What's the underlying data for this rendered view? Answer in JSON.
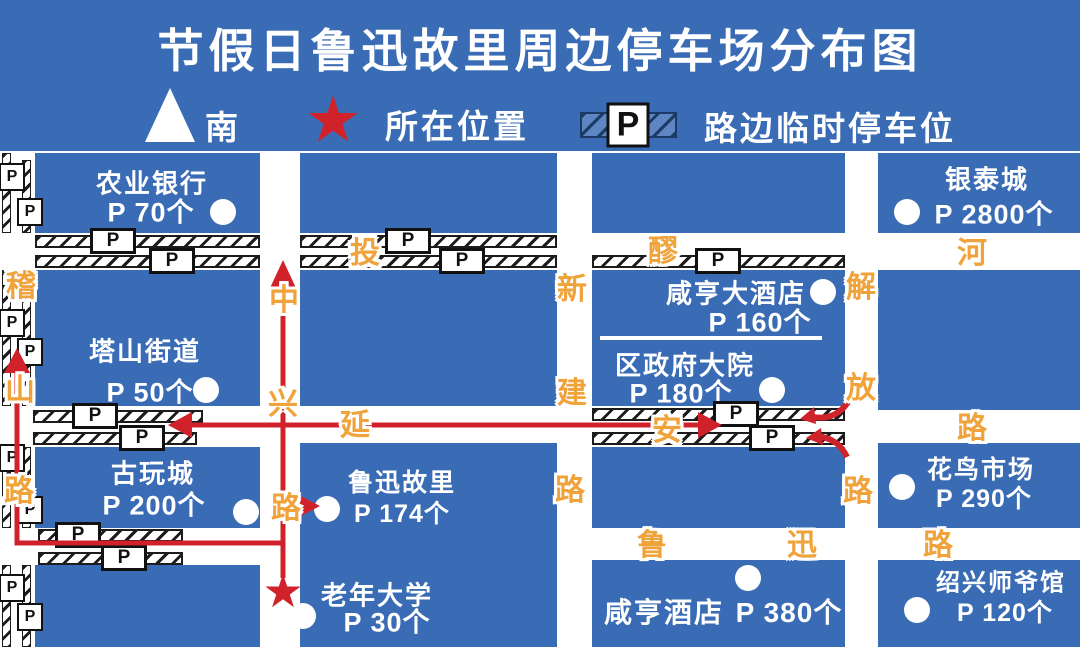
{
  "title": "节假日鲁迅故里周边停车场分布图",
  "colors": {
    "block_blue": "#3a6cb5",
    "road_white": "#ffffff",
    "street_name_orange": "#efa33a",
    "route_red": "#d0222a",
    "sign_black": "#1c1c1c"
  },
  "legend": {
    "south": "南",
    "current_location": "所在位置",
    "roadside_parking": "路边临时停车位"
  },
  "symbols": {
    "p": "P",
    "star": "★"
  },
  "venues": {
    "nongye_bank": {
      "name": "农业银行",
      "capacity": "P 70个"
    },
    "yintai_city": {
      "name": "银泰城",
      "capacity": "P 2800个"
    },
    "tashan_street": {
      "name": "塔山街道",
      "capacity": "P 50个"
    },
    "xianheng_grand_hotel": {
      "name": "咸亨大酒店",
      "capacity": "P 160个"
    },
    "district_gov": {
      "name": "区政府大院",
      "capacity": "P 180个"
    },
    "antique_city": {
      "name": "古玩城",
      "capacity": "P 200个"
    },
    "luxun_hometown": {
      "name": "鲁迅故里",
      "capacity": "P 174个"
    },
    "flower_bird_market": {
      "name": "花鸟市场",
      "capacity": "P 290个"
    },
    "senior_university": {
      "name": "老年大学",
      "capacity": "P 30个"
    },
    "xianheng_hotel": {
      "name": "咸亨酒店",
      "capacity": "P 380个"
    },
    "shaoxing_shiye_museum": {
      "name": "绍兴师爷馆",
      "capacity": "P 120个"
    }
  },
  "roads": {
    "toulao_river": {
      "name": "投醪河",
      "chars": [
        "投",
        "醪",
        "河"
      ]
    },
    "yanan_road": {
      "name": "延安路",
      "chars": [
        "延",
        "安",
        "路"
      ]
    },
    "luxun_road": {
      "name": "鲁迅路",
      "chars": [
        "鲁",
        "迅",
        "路"
      ]
    },
    "jishan_road": {
      "name": "稽山路",
      "chars": [
        "稽",
        "山",
        "路"
      ]
    },
    "zhongxing_road": {
      "name": "中兴路",
      "chars": [
        "中",
        "兴",
        "路"
      ]
    },
    "xinjian_road": {
      "name": "新建路",
      "chars": [
        "新",
        "建",
        "路"
      ]
    },
    "jiefang_road": {
      "name": "解放路",
      "chars": [
        "解",
        "放",
        "路"
      ]
    }
  }
}
